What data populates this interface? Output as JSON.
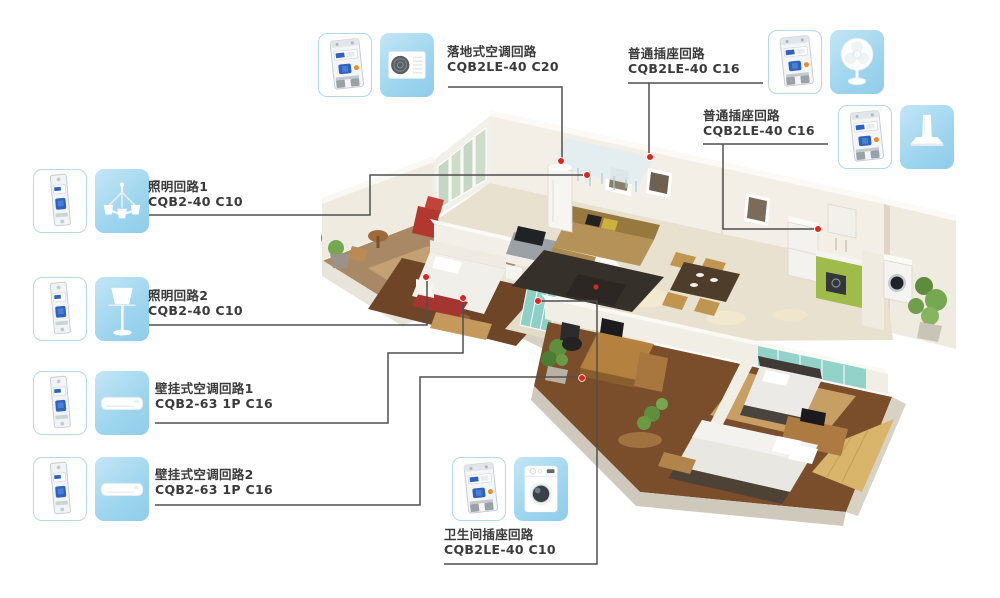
{
  "figure": {
    "description_visible": "",
    "type": "home circuit application diagram"
  },
  "colors": {
    "tile_blue": "#9ed5ee",
    "tile_border": "#b2d8ea",
    "breaker_blue": "#2e64c0",
    "dot_red": "#e2231a",
    "line_gray": "#4f4f4f",
    "text_dark": "#3a3a3a"
  },
  "circuits": [
    {
      "id": "floor-ac",
      "name": "落地式空调回路",
      "model": "CQB2LE-40 C20",
      "breaker_icon": "breaker-2p-rcbo",
      "appliance_icon": "ac-outdoor-unit"
    },
    {
      "id": "socket-fan",
      "name": "普通插座回路",
      "model": "CQB2LE-40 C16",
      "breaker_icon": "breaker-2p-rcbo",
      "appliance_icon": "table-fan"
    },
    {
      "id": "socket-hood",
      "name": "普通插座回路",
      "model": "CQB2LE-40 C16",
      "breaker_icon": "breaker-2p-rcbo",
      "appliance_icon": "range-hood"
    },
    {
      "id": "light-1",
      "name": "照明回路1",
      "model": "CQB2-40 C10",
      "breaker_icon": "breaker-1p-mcb",
      "appliance_icon": "chandelier"
    },
    {
      "id": "light-2",
      "name": "照明回路2",
      "model": "CQB2-40 C10",
      "breaker_icon": "breaker-1p-mcb",
      "appliance_icon": "floor-lamp"
    },
    {
      "id": "wall-ac-1",
      "name": "壁挂式空调回路1",
      "model": "CQB2-63 1P C16",
      "breaker_icon": "breaker-1p-mcb",
      "appliance_icon": "wall-ac-unit"
    },
    {
      "id": "wall-ac-2",
      "name": "壁挂式空调回路2",
      "model": "CQB2-63 1P C16",
      "breaker_icon": "breaker-1p-mcb",
      "appliance_icon": "wall-ac-unit"
    },
    {
      "id": "bath-socket",
      "name": "卫生间插座回路",
      "model": "CQB2LE-40 C10",
      "breaker_icon": "breaker-2p-rcbo",
      "appliance_icon": "washing-machine"
    }
  ]
}
